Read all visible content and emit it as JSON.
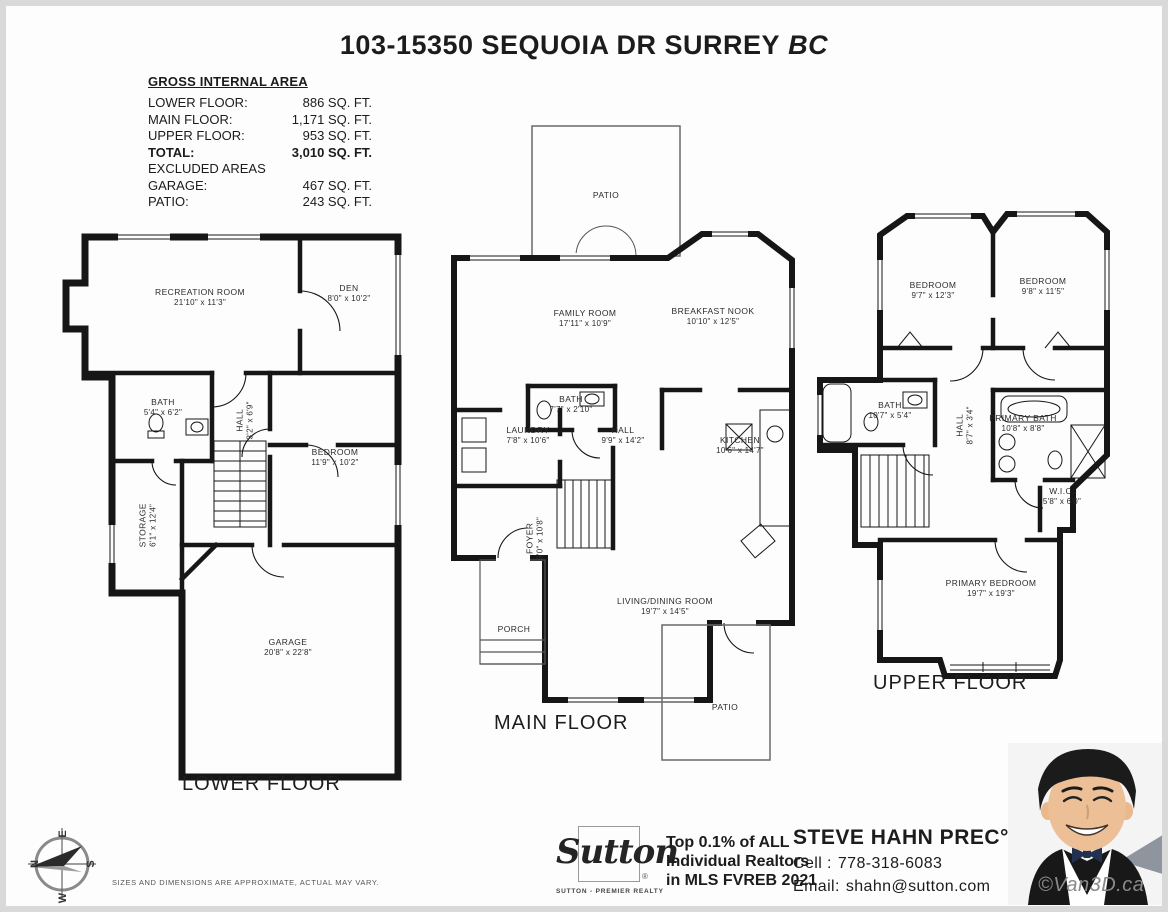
{
  "title": {
    "main": "103-15350 SEQUOIA DR SURREY",
    "suffix": "BC"
  },
  "area_table": {
    "heading": "GROSS INTERNAL AREA",
    "rows": [
      {
        "label": "LOWER FLOOR:",
        "value": "886 SQ. FT."
      },
      {
        "label": "MAIN FLOOR:",
        "value": "1,171 SQ. FT."
      },
      {
        "label": "UPPER FLOOR:",
        "value": "953 SQ. FT."
      },
      {
        "label": "TOTAL:",
        "value": "3,010 SQ. FT."
      },
      {
        "label": "EXCLUDED AREAS",
        "value": ""
      },
      {
        "label": "GARAGE:",
        "value": "467 SQ. FT."
      },
      {
        "label": "PATIO:",
        "value": "243 SQ. FT."
      }
    ]
  },
  "floors": {
    "lower": {
      "name": "LOWER FLOOR",
      "rooms": {
        "recreation": {
          "name": "RECREATION ROOM",
          "dims": "21'10\" x 11'3\""
        },
        "den": {
          "name": "DEN",
          "dims": "8'0\" x 10'2\""
        },
        "bath": {
          "name": "BATH",
          "dims": "5'4\" x 6'2\""
        },
        "hall": {
          "name": "HALL",
          "dims": "3'2\" x 6'9\""
        },
        "bedroom": {
          "name": "BEDROOM",
          "dims": "11'9\" x 10'2\""
        },
        "storage": {
          "name": "STORAGE",
          "dims": "6'1\" x 12'4\""
        },
        "garage": {
          "name": "GARAGE",
          "dims": "20'8\" x 22'8\""
        }
      }
    },
    "main": {
      "name": "MAIN FLOOR",
      "rooms": {
        "patio_top": {
          "name": "PATIO",
          "dims": ""
        },
        "family": {
          "name": "FAMILY ROOM",
          "dims": "17'11\" x 10'9\""
        },
        "nook": {
          "name": "BREAKFAST NOOK",
          "dims": "10'10\" x 12'5\""
        },
        "bath": {
          "name": "BATH",
          "dims": "7'7\" x 2'10\""
        },
        "laundry": {
          "name": "LAUNDRY",
          "dims": "7'8\" x 10'6\""
        },
        "hall": {
          "name": "HALL",
          "dims": "9'9\" x 14'2\""
        },
        "kitchen": {
          "name": "KITCHEN",
          "dims": "10'6\" x 14'7\""
        },
        "foyer": {
          "name": "FOYER",
          "dims": "6'0\" x 10'8\""
        },
        "living": {
          "name": "LIVING/DINING ROOM",
          "dims": "19'7\" x 14'5\""
        },
        "porch": {
          "name": "PORCH",
          "dims": ""
        },
        "patio_bottom": {
          "name": "PATIO",
          "dims": ""
        }
      }
    },
    "upper": {
      "name": "UPPER FLOOR",
      "rooms": {
        "bedroom1": {
          "name": "BEDROOM",
          "dims": "9'7\" x 12'3\""
        },
        "bedroom2": {
          "name": "BEDROOM",
          "dims": "9'8\" x 11'5\""
        },
        "bath": {
          "name": "BATH",
          "dims": "10'7\" x 5'4\""
        },
        "hall": {
          "name": "HALL",
          "dims": "8'7\" x 3'4\""
        },
        "primary_bath": {
          "name": "PRIMARY BATH",
          "dims": "10'8\" x 8'8\""
        },
        "wic": {
          "name": "W.I.C.",
          "dims": "5'8\" x 6'0\""
        },
        "primary_bedroom": {
          "name": "PRIMARY BEDROOM",
          "dims": "19'7\" x 19'3\""
        }
      }
    }
  },
  "compass": {
    "n": "N",
    "e": "E",
    "s": "S",
    "w": "W"
  },
  "disclaimer": "SIZES AND DIMENSIONS ARE APPROXIMATE, ACTUAL MAY VARY.",
  "branding": {
    "logo_text": "Sutton",
    "logo_reg": "®",
    "tagline": "SUTTON - PREMIER REALTY",
    "award_line1": "Top 0.1% of ALL",
    "award_line2": "Individual Realtors",
    "award_line3": "in MLS FVREB 2021",
    "agent_name": "STEVE HAHN PREC°",
    "cell_label": "Cell :",
    "cell_number": "778-318-6083",
    "email_label": "Email:",
    "email_address": "shahn@sutton.com",
    "watermark": "©Van3D.ca"
  }
}
